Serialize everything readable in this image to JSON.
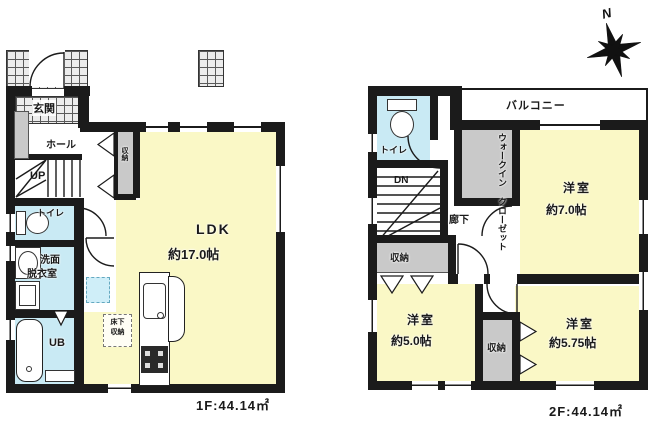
{
  "compass": {
    "north": "N"
  },
  "colors": {
    "room_yellow": "#faf8c6",
    "wet_blue": "#c9eaf4",
    "closet_gray": "#c9c9c9",
    "wall_black": "#1b1b1b",
    "tile_gray": "#ececec"
  },
  "floor1": {
    "area_label": "1F:44.14㎡",
    "genkan": "玄関",
    "hall": "ホール",
    "stairs": "UP",
    "hall_closet": "収納",
    "toilet": "トイレ",
    "washroom_line1": "洗面",
    "washroom_line2": "脱衣室",
    "bath": "UB",
    "ldk_line1": "LDK",
    "ldk_line2": "約17.0帖",
    "underfloor_line1": "床下",
    "underfloor_line2": "収納"
  },
  "floor2": {
    "area_label": "2F:44.14㎡",
    "balcony": "バルコニー",
    "toilet": "トイレ",
    "stairs": "DN",
    "corridor": "廊下",
    "wic_line1": "ウォークイン",
    "wic_line2": "クローゼット",
    "bedroom_main_name": "洋室",
    "bedroom_main_size": "約7.0帖",
    "bedroom_west_name": "洋室",
    "bedroom_west_size": "約5.0帖",
    "bedroom_east_name": "洋室",
    "bedroom_east_size": "約5.75帖",
    "closet_a": "収納",
    "closet_b": "収納"
  }
}
